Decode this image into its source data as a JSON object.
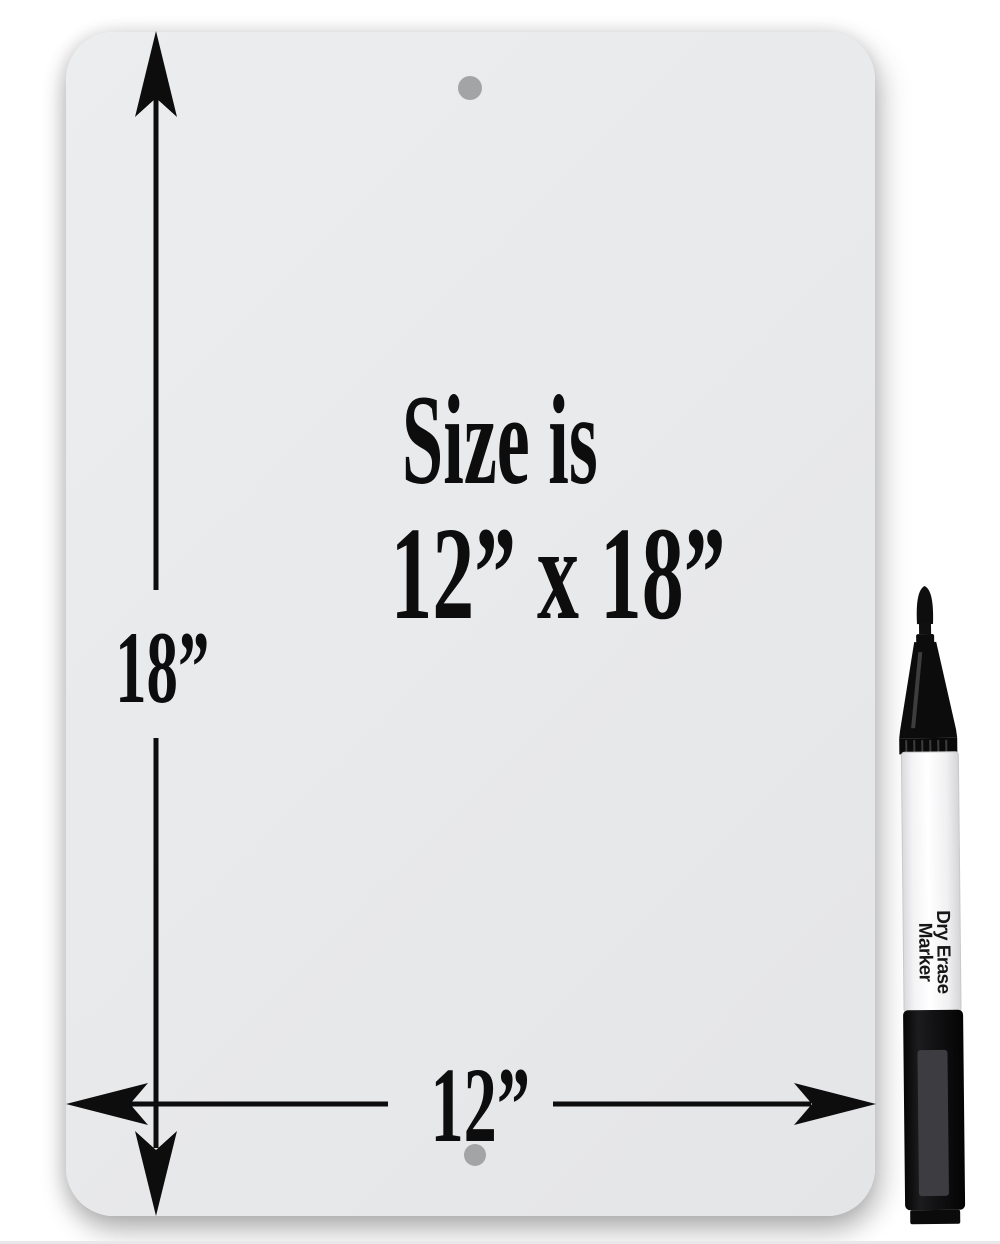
{
  "scene": {
    "board": {
      "caption_line1": "Size is",
      "caption_line2": "12” x 18”",
      "height_label": "18”",
      "width_label": "12”"
    },
    "marker": {
      "label_line1": "Dry Erase",
      "label_line2": "Marker"
    },
    "colors": {
      "board_fill": "#e8e9eb",
      "hole_gray": "#a3a4a6",
      "ink_black": "#0d0d0d",
      "marker_cap_black": "#121212",
      "marker_barrel_white": "#fafafa"
    }
  }
}
